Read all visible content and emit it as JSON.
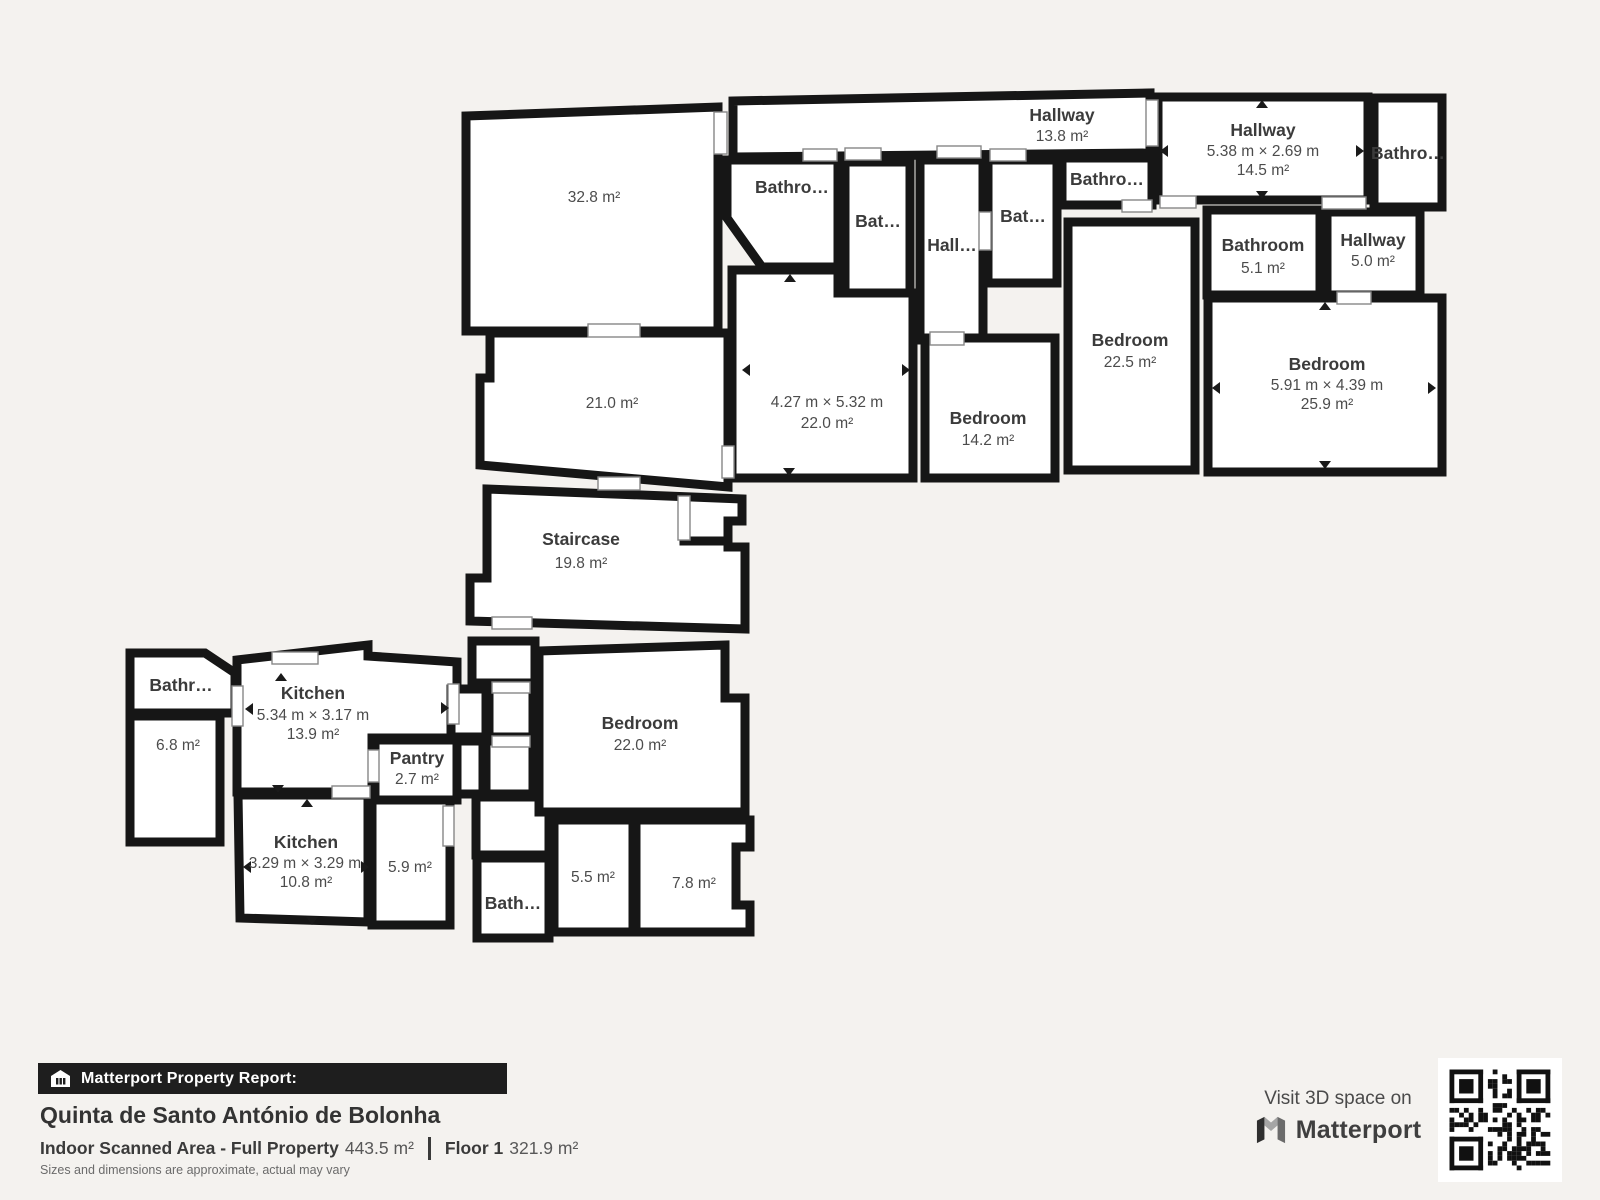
{
  "colors": {
    "wall": "#161616",
    "room_fill": "#ffffff",
    "background": "#f4f2ef",
    "footer_bar": "#1e1e1e"
  },
  "plan": {
    "rooms": {
      "room_32_8": {
        "area": "32.8 m²"
      },
      "room_21_0": {
        "area": "21.0 m²"
      },
      "staircase": {
        "name": "Staircase",
        "area": "19.8 m²"
      },
      "hallway_13_8": {
        "name": "Hallway",
        "area": "13.8 m²"
      },
      "bathroom_a": {
        "name": "Bathro…"
      },
      "bathroom_b": {
        "name": "Bat…"
      },
      "hallway_small": {
        "name": "Hall…"
      },
      "bathroom_c": {
        "name": "Bat…"
      },
      "bathroom_d": {
        "name": "Bathro…"
      },
      "room_22_0": {
        "dims": "4.27 m × 5.32 m",
        "area": "22.0 m²"
      },
      "bedroom_14_2": {
        "name": "Bedroom",
        "area": "14.2 m²"
      },
      "bedroom_22_5": {
        "name": "Bedroom",
        "area": "22.5 m²"
      },
      "hallway_14_5": {
        "name": "Hallway",
        "dims": "5.38 m × 2.69 m",
        "area": "14.5 m²"
      },
      "bathroom_e": {
        "name": "Bathro…"
      },
      "bathroom_5_1": {
        "name": "Bathroom",
        "area": "5.1 m²"
      },
      "hallway_5_0": {
        "name": "Hallway",
        "area": "5.0 m²"
      },
      "bedroom_25_9": {
        "name": "Bedroom",
        "dims": "5.91 m × 4.39 m",
        "area": "25.9 m²"
      },
      "bathroom_f": {
        "name": "Bathr…"
      },
      "room_6_8": {
        "area": "6.8 m²"
      },
      "kitchen_13_9": {
        "name": "Kitchen",
        "dims": "5.34 m × 3.17 m",
        "area": "13.9 m²"
      },
      "pantry": {
        "name": "Pantry",
        "area": "2.7 m²"
      },
      "kitchen_10_8": {
        "name": "Kitchen",
        "dims": "3.29 m × 3.29 m",
        "area": "10.8 m²"
      },
      "room_5_9": {
        "area": "5.9 m²"
      },
      "bedroom_22_0b": {
        "name": "Bedroom",
        "area": "22.0 m²"
      },
      "bathroom_g": {
        "name": "Bath…"
      },
      "room_5_5": {
        "area": "5.5 m²"
      },
      "room_7_8": {
        "area": "7.8 m²"
      }
    }
  },
  "footer": {
    "report_label": "Matterport Property Report:",
    "property_title": "Quinta de Santo António de Bolonha",
    "scanned_area_label": "Indoor Scanned Area - Full Property",
    "scanned_area_value": "443.5 m²",
    "floor_label": "Floor 1",
    "floor_area_value": "321.9 m²",
    "disclaimer": "Sizes and dimensions are approximate, actual may vary",
    "visit_label": "Visit 3D space on",
    "brand_name": "Matterport"
  }
}
